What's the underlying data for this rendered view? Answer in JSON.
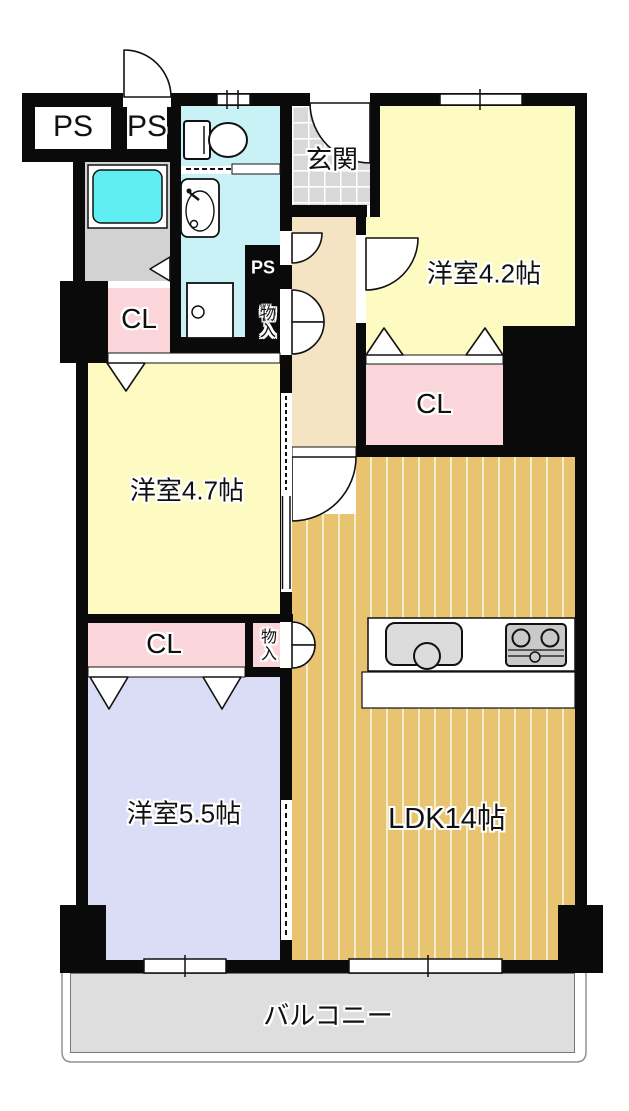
{
  "rooms": {
    "ps1": {
      "label": "PS"
    },
    "ps2": {
      "label": "PS"
    },
    "genkan": {
      "label": "玄関"
    },
    "western42": {
      "label": "洋室4.2帖"
    },
    "cl_upper": {
      "label": "CL"
    },
    "ps_small": {
      "label": "PS"
    },
    "storage_upper": {
      "label": "物入"
    },
    "western47": {
      "label": "洋室4.7帖"
    },
    "cl_right": {
      "label": "CL"
    },
    "ldk": {
      "label": "LDK14帖"
    },
    "cl_lower": {
      "label": "CL"
    },
    "storage_lower": {
      "label": "物入"
    },
    "western55": {
      "label": "洋室5.5帖"
    },
    "balcony": {
      "label": "バルコニー"
    }
  },
  "fixtures": {
    "toilet": "toilet-icon",
    "washbasin": "washbasin-icon",
    "washing_machine": "washing-machine-icon",
    "bathtub": "bathtub-icon",
    "kitchen_sink": "kitchen-sink-icon",
    "stove": "stove-icon"
  },
  "colors": {
    "wall": "#0a0a0a",
    "room_yellow": "#FDFBC1",
    "closet_pink": "#FAD6DA",
    "room_lavender": "#DBDCF5",
    "wet_area_cyan": "#C8F2F5",
    "bathtub_cyan": "#5FEFF2",
    "bath_gray": "#D2D2D2",
    "tile_gray": "#D8D8D8",
    "corridor_beige": "#F4E4C3",
    "ldk_floor": "#E8C470",
    "ldk_stripe": "#F6ECCE",
    "balcony_gray": "#DEDEDE"
  }
}
